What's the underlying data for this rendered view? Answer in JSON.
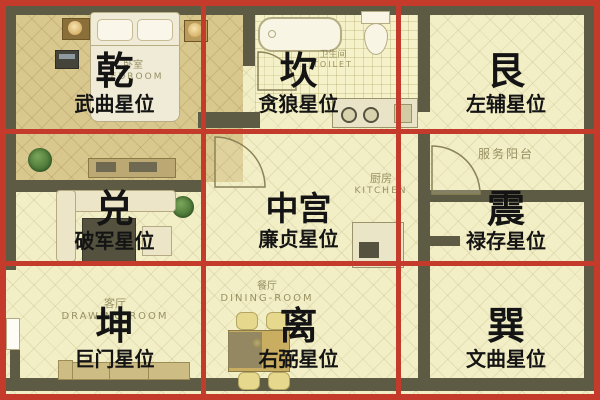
{
  "palette": {
    "grid_red": "#c43a2b",
    "floor_pale": "#f2eec6",
    "floor_bedroom": "#d9c88e",
    "wall_olive": "#5e5b45",
    "overlay_text": "#141414"
  },
  "overlay": {
    "cells": [
      {
        "trigram": "乾",
        "star": "武曲星位"
      },
      {
        "trigram": "坎",
        "star": "贪狼星位"
      },
      {
        "trigram": "艮",
        "star": "左辅星位"
      },
      {
        "trigram": "兑",
        "star": "破军星位"
      },
      {
        "trigram": "中宫",
        "star": "廉贞星位"
      },
      {
        "trigram": "震",
        "star": "禄存星位"
      },
      {
        "trigram": "坤",
        "star": "巨门星位"
      },
      {
        "trigram": "离",
        "star": "右弼星位"
      },
      {
        "trigram": "巽",
        "star": "文曲星位"
      }
    ]
  },
  "floorplan": {
    "bedroom": {
      "cn": "卧室",
      "en": "BEDROOM"
    },
    "toilet": {
      "cn": "卫生间",
      "en": "TOILET"
    },
    "kitchen": {
      "cn": "厨房",
      "en": "KITCHEN"
    },
    "service_balcony": {
      "cn": "服务阳台"
    },
    "drawing_room": {
      "cn": "客厅",
      "en": "DRAWING ROOM"
    },
    "dining_room": {
      "cn": "餐厅",
      "en": "DINING-ROOM"
    }
  }
}
